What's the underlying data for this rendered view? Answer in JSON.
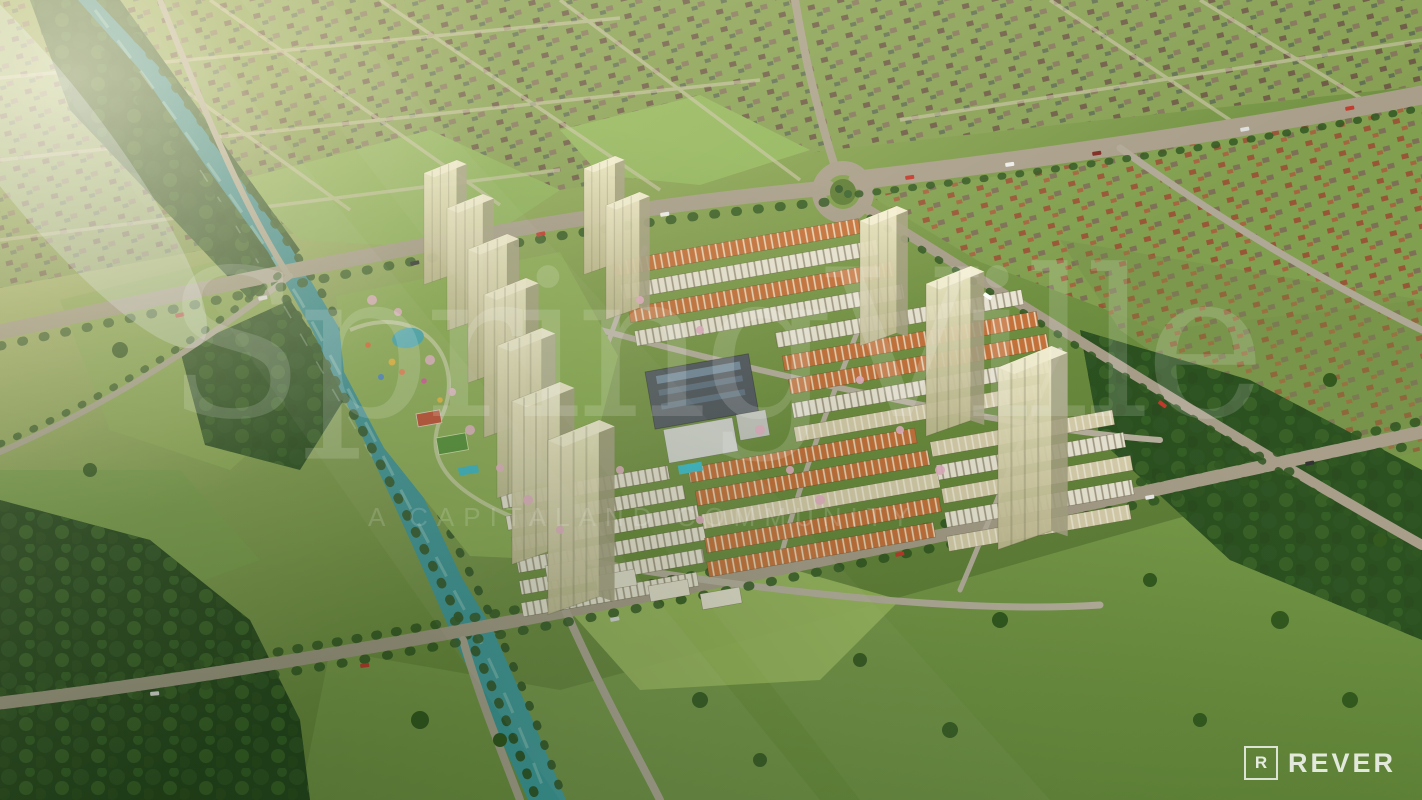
{
  "watermark": {
    "title": "SpringVille",
    "tagline": "A CAPITALAND COMMUNITY"
  },
  "brand_logo": {
    "symbol": "R",
    "name": "REVER"
  },
  "palette": {
    "river": "#3a96a0",
    "grass": "#7a9a4a",
    "forest": "#2f5424",
    "road": "#a89e8a",
    "townhouse_white": "#e9e4d3",
    "townhouse_terracotta": "#c8733c",
    "tower_glass": "#ded7ae",
    "blossom_pink": "#e8b7c9",
    "watermark_white": "rgba(255,255,255,0.15)"
  }
}
